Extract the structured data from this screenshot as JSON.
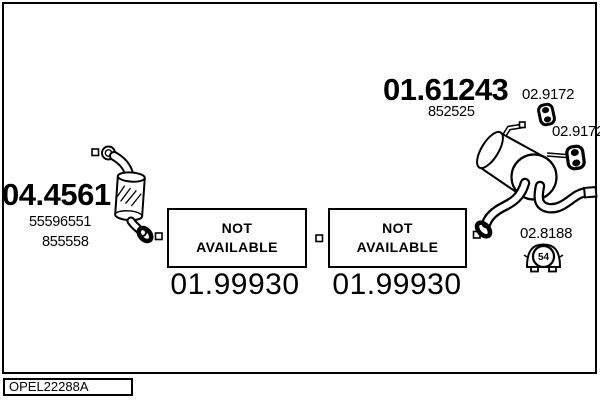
{
  "diagram": {
    "footer_code": "OPEL22288A",
    "colors": {
      "ink": "#000000",
      "background": "#ffffff"
    },
    "parts": {
      "catalyst": {
        "part_number": "04.4561",
        "oe_ref_1": "55596551",
        "oe_ref_2": "855558"
      },
      "rear_muffler": {
        "part_number": "01.61243",
        "oe_ref": "852525"
      },
      "hanger_upper": {
        "part_number": "02.9172"
      },
      "hanger_lower": {
        "part_number": "02.9172"
      },
      "mounting_kit": {
        "part_number": "02.8188",
        "badge_number": "54"
      },
      "mid_pipe_left": {
        "part_number": "01.99930",
        "status_line1": "NOT",
        "status_line2": "AVAILABLE"
      },
      "mid_pipe_right": {
        "part_number": "01.99930",
        "status_line1": "NOT",
        "status_line2": "AVAILABLE"
      }
    }
  }
}
